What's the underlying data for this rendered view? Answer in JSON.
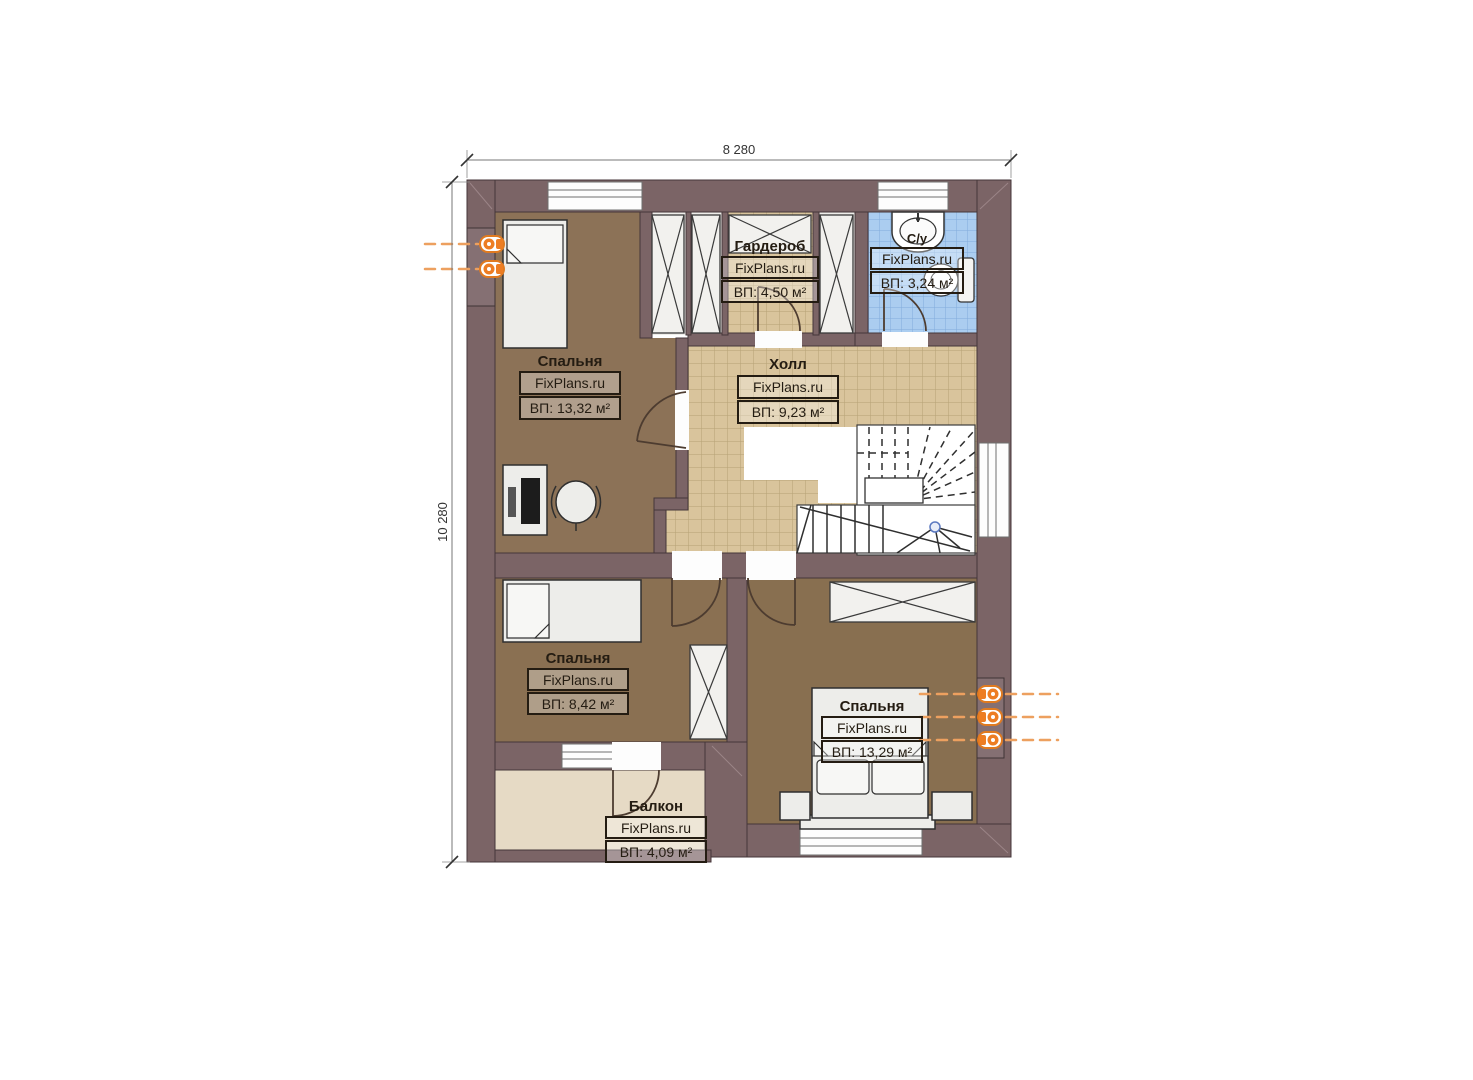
{
  "plan": {
    "brand": "FixPlans.ru",
    "dimensions": {
      "width": "8 280",
      "height": "10 280"
    },
    "rooms": [
      {
        "name": "Спальня",
        "area": "ВП: 13,32 м²"
      },
      {
        "name": "Гардероб",
        "area": "ВП: 4,50 м²"
      },
      {
        "name": "С/у",
        "area": "ВП: 3,24 м²"
      },
      {
        "name": "Холл",
        "area": "ВП: 9,23 м²"
      },
      {
        "name": "Спальня",
        "area": "ВП: 8,42 м²"
      },
      {
        "name": "Спальня",
        "area": "ВП: 13,29 м²"
      },
      {
        "name": "Балкон",
        "area": "ВП: 4,09 м²"
      }
    ],
    "colors": {
      "wall": "#7b6466",
      "floor_wood": "#8c7257",
      "floor_tile": "#d9c49c",
      "floor_bath": "#abcdf0",
      "floor_balcony": "#e6dac5",
      "radiator": "#ed7d23"
    }
  }
}
